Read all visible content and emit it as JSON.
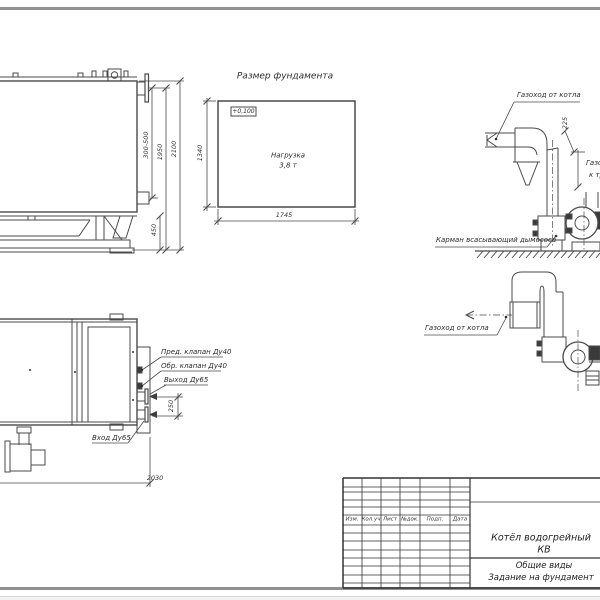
{
  "colors": {
    "line": "#4a4a4a",
    "sheet_edge": "#909090",
    "text": "#2c2c2c"
  },
  "side_view": {
    "dim_stub_range": "300-500",
    "dim_height_flange": "1950",
    "dim_height_total": "2100",
    "dim_base": "450"
  },
  "foundation": {
    "title": "Размер фундамента",
    "elevation": "+0,100",
    "load_line1": "Нагрузка",
    "load_line2": "3,8 т",
    "dim_width": "1745",
    "dim_depth": "1340"
  },
  "duct_top": {
    "label_inlet": "Газоход от котла",
    "dim_offset": "225",
    "label_pocket": "Карман всасывающий дымососа",
    "label_outlet_line1": "Газоход",
    "label_outlet_line2": "к трубе"
  },
  "duct_front": {
    "label_inlet": "Газоход от котла"
  },
  "plan_view": {
    "label_safety_valve": "Пред. клапан Ду40",
    "label_check_valve": "Обр. клапан Ду40",
    "label_outlet": "Выход Ду65",
    "label_inlet": "Вход Ду65",
    "dim_nozzle_spacing": "250",
    "dim_length": "2030"
  },
  "title_block": {
    "columns": [
      "Изм.",
      "Кол.уч",
      "Лист",
      "№док.",
      "Подп.",
      "Дата"
    ],
    "product_line1": "Котёл водогрейный",
    "product_line2": "КВ",
    "doc_line1": "Общие виды",
    "doc_line2": "Задание на фундамент"
  }
}
